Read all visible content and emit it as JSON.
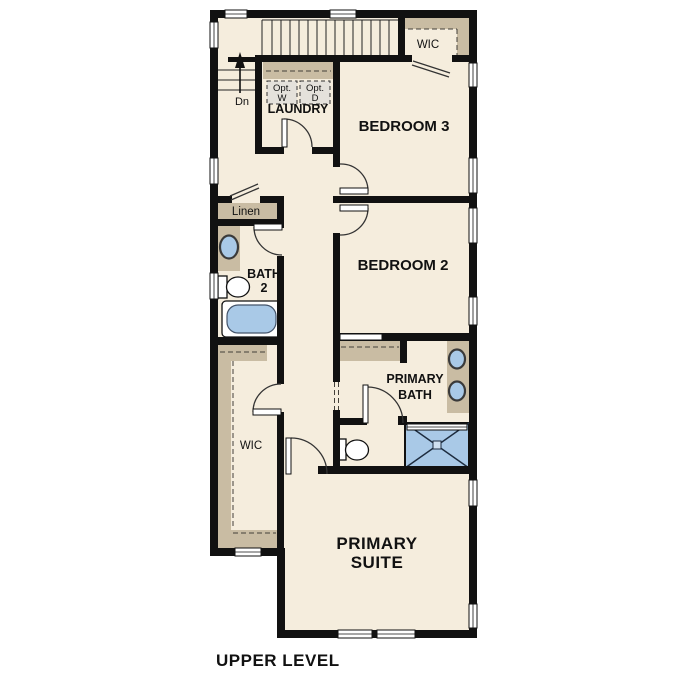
{
  "plan": {
    "title": "UPPER LEVEL",
    "labels": {
      "bedroom3": "BEDROOM 3",
      "bedroom2": "BEDROOM 2",
      "primary_suite": [
        "PRIMARY",
        "SUITE"
      ],
      "primary_bath": [
        "PRIMARY",
        "BATH"
      ],
      "bath2": [
        "BATH",
        "2"
      ],
      "laundry": "LAUNDRY",
      "wic_bedroom3": "WIC",
      "wic_primary": "WIC",
      "linen": "Linen",
      "stairs_down": "Dn",
      "opt_washer": [
        "Opt.",
        "W"
      ],
      "opt_dryer": [
        "Opt.",
        "D"
      ]
    },
    "colors": {
      "background": "#ffffff",
      "wall": "#111111",
      "floor": "#f5eddd",
      "cabinet_tan": "#c9bca3",
      "fixture_blue": "#a9c9e7",
      "appliance_gray": "#e4e1db"
    }
  }
}
